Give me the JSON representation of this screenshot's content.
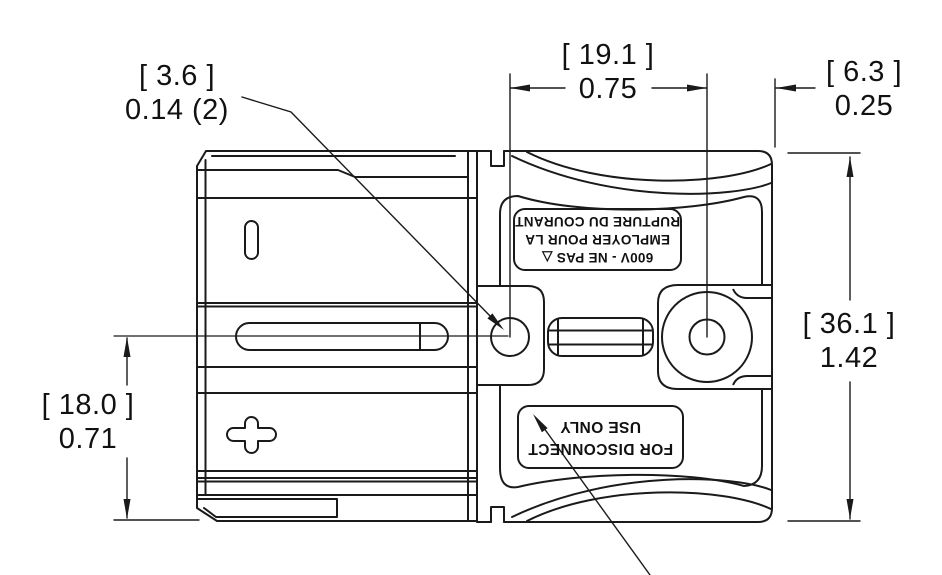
{
  "dimensions": {
    "hole_diameter": {
      "metric": "[ 3.6 ]",
      "imperial": "0.14 (2)"
    },
    "hole_spacing": {
      "metric": "[ 19.1 ]",
      "imperial": "0.75"
    },
    "edge_offset": {
      "metric": "[ 6.3 ]",
      "imperial": "0.25"
    },
    "overall_height": {
      "metric": "[ 36.1 ]",
      "imperial": "1.42"
    },
    "centerline_height": {
      "metric": "[ 18.0 ]",
      "imperial": "0.71"
    }
  },
  "connector_labels": {
    "french_warning": {
      "line1": "600V - NE PAS  △",
      "line2": "EMPLOYER POUR LA",
      "line3": "RUPTURE DU COURANT"
    },
    "english_warning": {
      "line1": "FOR DISCONNECT",
      "line2": "USE ONLY"
    }
  },
  "colors": {
    "line": "#1a1a1a",
    "background": "#ffffff"
  }
}
